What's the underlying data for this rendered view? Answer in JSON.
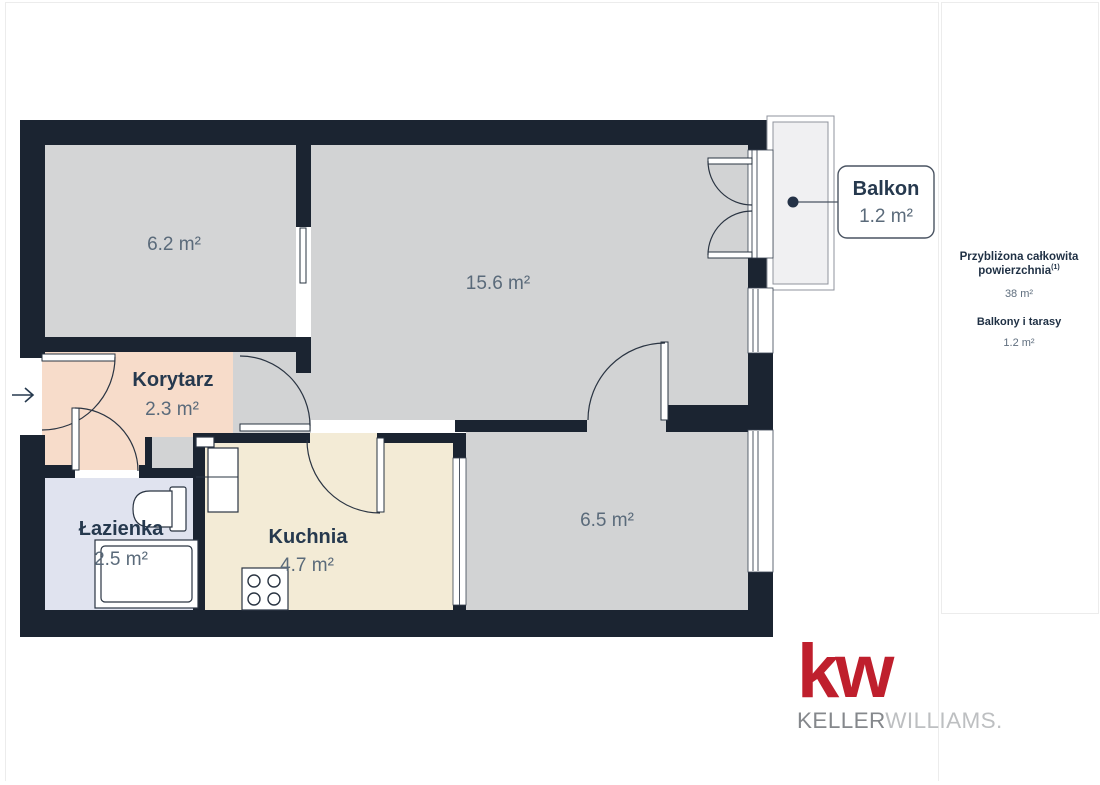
{
  "plan": {
    "labels": {
      "room62_area": "6.2 m²",
      "living_area": "15.6 m²",
      "korytarz_name": "Korytarz",
      "korytarz_area": "2.3 m²",
      "lazienka_name": "Łazienka",
      "lazienka_area": "2.5 m²",
      "kuchnia_name": "Kuchnia",
      "kuchnia_area": "4.7 m²",
      "room65_area": "6.5 m²"
    },
    "balcony_callout": {
      "name": "Balkon",
      "area": "1.2 m²"
    }
  },
  "side_panel": {
    "heading_line1": "Przybliżona całkowita",
    "heading_line2": "powierzchnia",
    "heading_sup": "(1)",
    "total_area": "38 m²",
    "balconies_label": "Balkony i tarasy",
    "balconies_value": "1.2 m²"
  },
  "logo": {
    "kw": "kw",
    "keller": "KELLER",
    "williams": "WILLIAMS",
    "registered": "."
  },
  "colors": {
    "wall": "#1b2431",
    "floor_gray": "#d2d3d4",
    "corridor_peach": "#f7dcca",
    "bathroom_lavender": "#e0e3ef",
    "kitchen_cream": "#f3ebd6",
    "balcony_fill": "#f0f0f2",
    "label_navy": "#26394e",
    "label_gray": "#5a6a7a",
    "kw_red": "#bf1f2d",
    "keller_gray": "#85888c",
    "williams_gray": "#bdbfc1"
  }
}
